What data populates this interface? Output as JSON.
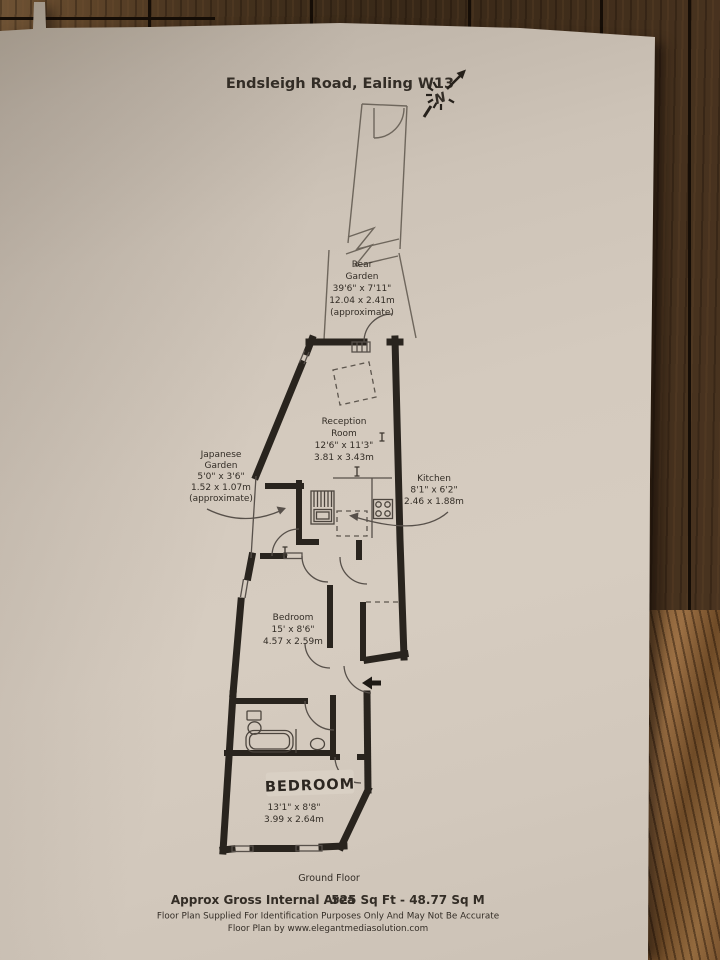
{
  "title": "Endsleigh Road, Ealing W13",
  "north": "N",
  "rear_garden": {
    "l1": "Rear",
    "l2": "Garden",
    "l3": "39'6\" x 7'11\"",
    "l4": "12.04 x 2.41m",
    "l5": "(approximate)"
  },
  "reception": {
    "l1": "Reception",
    "l2": "Room",
    "l3": "12'6\" x 11'3\"",
    "l4": "3.81 x 3.43m"
  },
  "japanese_garden": {
    "l1": "Japanese",
    "l2": "Garden",
    "l3": "5'0\" x 3'6\"",
    "l4": "1.52 x 1.07m",
    "l5": "(approximate)"
  },
  "kitchen": {
    "l1": "Kitchen",
    "l2": "8'1\" x 6'2\"",
    "l3": "2.46 x 1.88m"
  },
  "bedroom_1": {
    "l1": "Bedroom",
    "l2": "15' x 8'6\"",
    "l3": "4.57 x 2.59m"
  },
  "bedroom_2": {
    "handwritten": "BEDROOM",
    "l1": "13'1\" x 8'8\"",
    "l2": "3.99 x 2.64m"
  },
  "floor_label": "Ground Floor",
  "footer": {
    "area_label": "Approx Gross Internal Area",
    "area_value": "525 Sq Ft - 48.77 Sq M",
    "disclaimer": "Floor Plan Supplied For Identification Purposes Only And May Not Be Accurate",
    "credit": "Floor Plan by www.elegantmediasolution.com"
  },
  "colors": {
    "paper": "#d3c9bd",
    "ink": "#332d26",
    "wall": "#29241e",
    "wood_dark": "#3a2a19",
    "wood_light": "#9c7044"
  }
}
